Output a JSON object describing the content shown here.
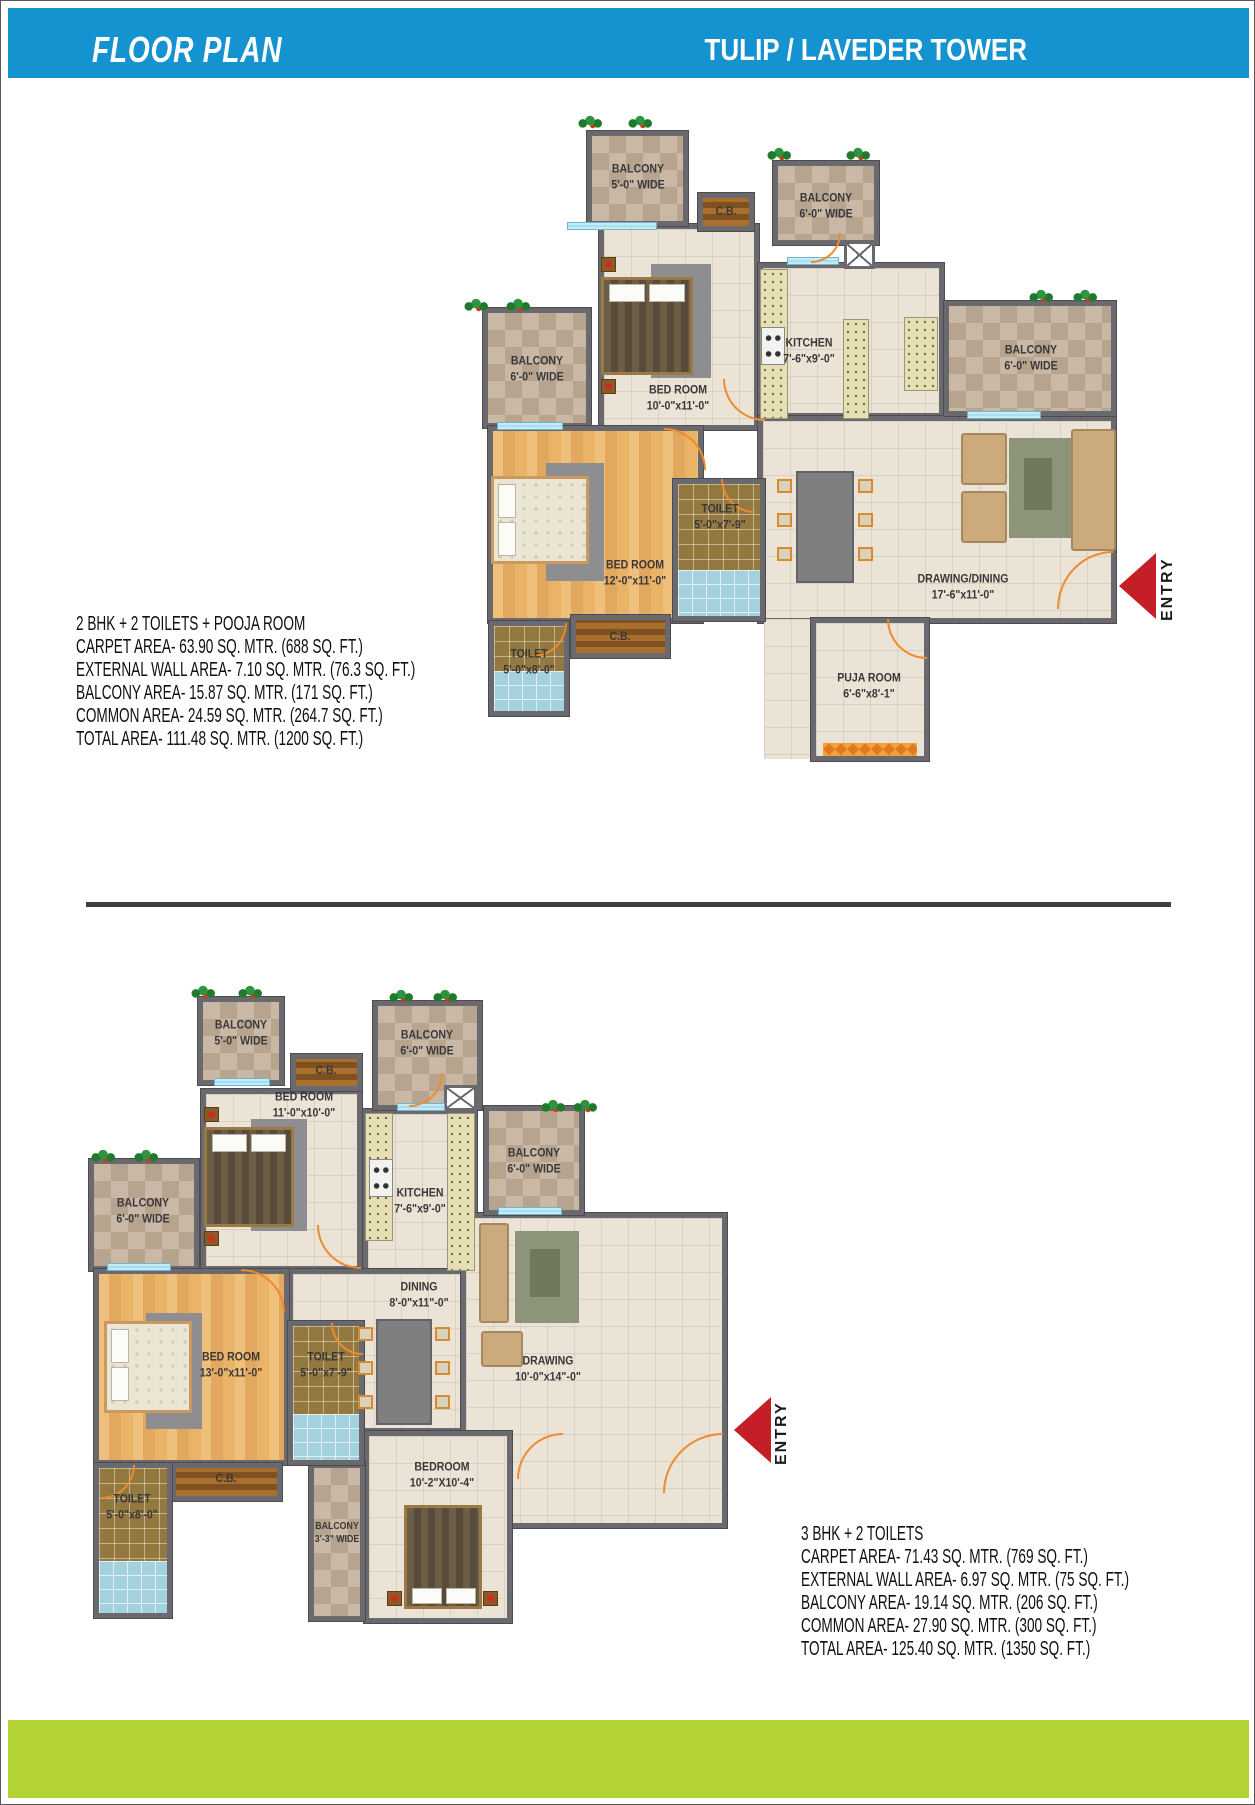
{
  "header": {
    "left_title": "FLOOR PLAN",
    "right_title": "TULIP / LAVEDER TOWER"
  },
  "colors": {
    "header_blue": "#1592d0",
    "footer_green": "#b3d335",
    "entry_red": "#c41e27",
    "door_orange": "#ef8a2d",
    "wall_gray": "#6a696e"
  },
  "plan_2bhk": {
    "entry_label": "ENTRY",
    "rooms": {
      "balcony_tl": {
        "name": "BALCONY",
        "dims": "5'-0\" WIDE"
      },
      "cb_top": {
        "name": "C.B."
      },
      "bedroom1": {
        "name": "BED ROOM",
        "dims": "10'-0\"x11'-0\""
      },
      "balcony_tr": {
        "name": "BALCONY",
        "dims": "6'-0\" WIDE"
      },
      "kitchen": {
        "name": "KITCHEN",
        "dims": "7'-6\"x9'-0\""
      },
      "balcony_r": {
        "name": "BALCONY",
        "dims": "6'-0\" WIDE"
      },
      "balcony_l": {
        "name": "BALCONY",
        "dims": "6'-0\" WIDE"
      },
      "bedroom2": {
        "name": "BED ROOM",
        "dims": "12'-0\"x11'-0\""
      },
      "toilet1": {
        "name": "TOILET",
        "dims": "5'-0\"x7'-9\""
      },
      "drawing": {
        "name": "DRAWING/DINING",
        "dims": "17'-6\"x11'-0\""
      },
      "cb_bottom": {
        "name": "C.B."
      },
      "toilet2": {
        "name": "TOILET",
        "dims": "5'-0\"x8'-0\""
      },
      "puja": {
        "name": "PUJA ROOM",
        "dims": "6'-6\"x8'-1\""
      }
    },
    "specs": {
      "title": "2 BHK + 2 TOILETS + POOJA ROOM",
      "lines": [
        "CARPET AREA- 63.90 SQ. MTR. (688 SQ. FT.)",
        "EXTERNAL WALL AREA- 7.10 SQ. MTR. (76.3 SQ. FT.)",
        "BALCONY AREA- 15.87 SQ. MTR. (171 SQ. FT.)",
        "COMMON AREA- 24.59 SQ. MTR. (264.7 SQ. FT.)",
        "TOTAL AREA- 111.48 SQ. MTR. (1200 SQ. FT.)"
      ]
    }
  },
  "plan_3bhk": {
    "entry_label": "ENTRY",
    "rooms": {
      "balcony_tl": {
        "name": "BALCONY",
        "dims": "5'-0\" WIDE"
      },
      "cb_top": {
        "name": "C.B."
      },
      "bedroom1": {
        "name": "BED ROOM",
        "dims": "11'-0\"x10'-0\""
      },
      "balcony_tm": {
        "name": "BALCONY",
        "dims": "6'-0\" WIDE"
      },
      "kitchen": {
        "name": "KITCHEN",
        "dims": "7'-6\"x9'-0\""
      },
      "balcony_r": {
        "name": "BALCONY",
        "dims": "6'-0\" WIDE"
      },
      "balcony_l": {
        "name": "BALCONY",
        "dims": "6'-0\" WIDE"
      },
      "dining": {
        "name": "DINING",
        "dims": "8'-0\"x11\"-0\""
      },
      "bedroom2": {
        "name": "BED ROOM",
        "dims": "13'-0\"x11'-0\""
      },
      "toilet1": {
        "name": "TOILET",
        "dims": "5'-0\"x7'-9\""
      },
      "drawing": {
        "name": "DRAWING",
        "dims": "10'-0\"x14\"-0\""
      },
      "cb_bottom": {
        "name": "C.B."
      },
      "toilet2": {
        "name": "TOILET",
        "dims": "5'-0\"x8'-0\""
      },
      "balcony_small": {
        "name": "BALCONY",
        "dims": "3'-3\" WIDE"
      },
      "bedroom3": {
        "name": "BEDROOM",
        "dims": "10'-2\"X10'-4\""
      }
    },
    "specs": {
      "title": "3 BHK + 2 TOILETS",
      "lines": [
        "CARPET AREA- 71.43 SQ. MTR. (769 SQ. FT.)",
        "EXTERNAL WALL AREA- 6.97 SQ. MTR. (75 SQ. FT.)",
        "BALCONY AREA- 19.14 SQ. MTR. (206 SQ. FT.)",
        "COMMON AREA- 27.90 SQ. MTR. (300 SQ. FT.)",
        "TOTAL AREA- 125.40 SQ. MTR. (1350 SQ. FT.)"
      ]
    }
  }
}
